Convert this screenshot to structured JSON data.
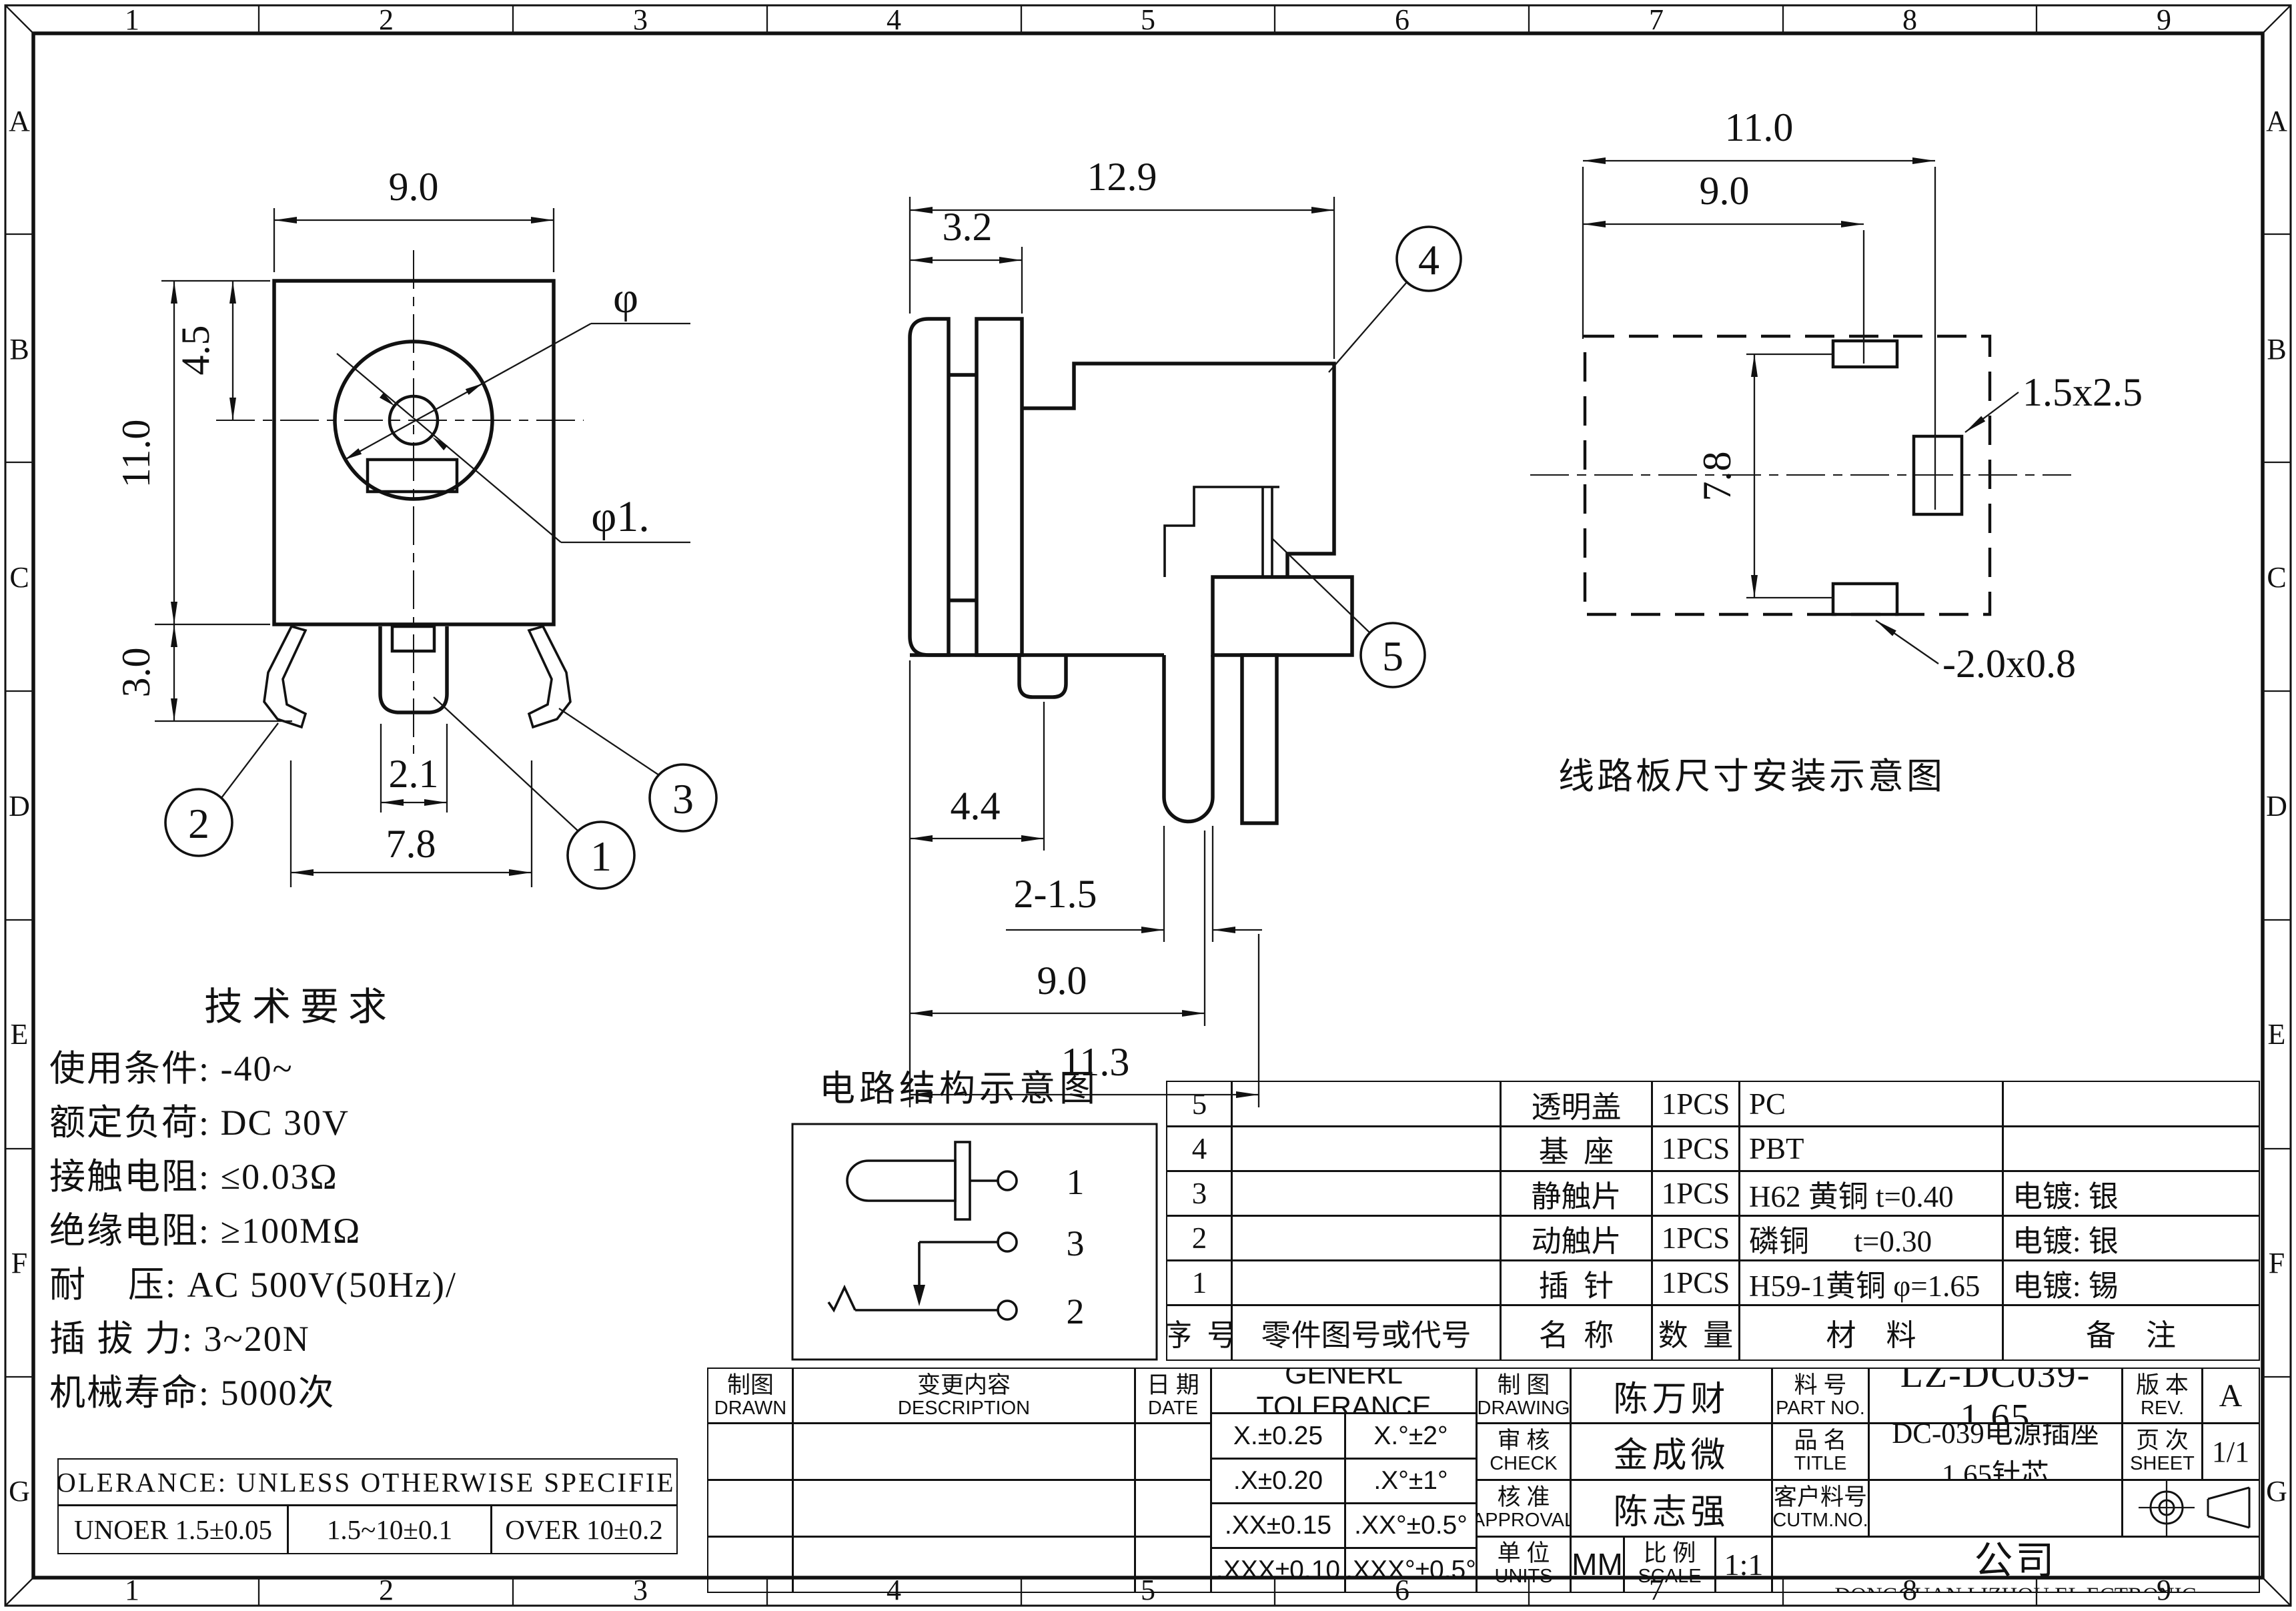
{
  "border": {
    "cols": [
      "1",
      "2",
      "3",
      "4",
      "5",
      "6",
      "7",
      "8",
      "9"
    ],
    "rows": [
      "A",
      "B",
      "C",
      "D",
      "E",
      "F",
      "G"
    ]
  },
  "front": {
    "w": "9.0",
    "ctr": "4.5",
    "h": "11.0",
    "leg": "3.0",
    "pin": "2.1",
    "span": "7.8",
    "dia": "φ",
    "dia1": "φ1.",
    "b1": "1",
    "b2": "2",
    "b3": "3"
  },
  "side": {
    "w": "12.9",
    "flange": "3.2",
    "tab": "4.4",
    "pins": "2-1.5",
    "span": "9.0",
    "total": "11.3",
    "b4": "4",
    "b5": "5"
  },
  "pcb": {
    "w": "11.0",
    "inner": "9.0",
    "h": "7.8",
    "slot_right": "1.5x2.5",
    "slot_bottom": "-2.0x0.8",
    "caption": "线路板尺寸安装示意图"
  },
  "circuit": {
    "title": "电路结构示意图",
    "t1": "1",
    "t3": "3",
    "t2": "2"
  },
  "tech": {
    "title": "技术要求",
    "line1": "使用条件: -40~",
    "line2": "额定负荷: DC 30V",
    "line3": "接触电阻: ≤0.03Ω",
    "line4": "绝缘电阻: ≥100MΩ",
    "line5": "耐    压: AC 500V(50Hz)/",
    "line6": "插 拔 力: 3~20N",
    "line7": "机械寿命: 5000次"
  },
  "tol": {
    "title": "TOLERANCE: UNLESS OTHERWISE SPECIFIED",
    "c1": "UNOER 1.5±0.05",
    "c2": "1.5~10±0.1",
    "c3": "OVER 10±0.2"
  },
  "parts": {
    "h_no": "序  号",
    "h_code": "零件图号或代号",
    "h_name": "名  称",
    "h_qty": "数  量",
    "h_mat": "材    料",
    "h_note": "备    注",
    "rows": [
      {
        "no": "5",
        "code": "",
        "name": "透明盖",
        "qty": "1PCS",
        "mat": "PC",
        "note": ""
      },
      {
        "no": "4",
        "code": "",
        "name": "基  座",
        "qty": "1PCS",
        "mat": "PBT",
        "note": ""
      },
      {
        "no": "3",
        "code": "",
        "name": "静触片",
        "qty": "1PCS",
        "mat": "H62 黄铜 t=0.40",
        "note": "电镀: 银"
      },
      {
        "no": "2",
        "code": "",
        "name": "动触片",
        "qty": "1PCS",
        "mat": "磷铜      t=0.30",
        "note": "电镀: 银"
      },
      {
        "no": "1",
        "code": "",
        "name": "插  针",
        "qty": "1PCS",
        "mat": "H59-1黄铜 φ=1.65",
        "note": "电镀: 锡"
      }
    ]
  },
  "tb": {
    "drawn_cn": "制图",
    "drawn_en": "DRAWN",
    "desc_cn": "变更内容",
    "desc_en": "DESCRIPTION",
    "date_cn": "日 期",
    "date_en": "DATE",
    "tol_header": "GENERL TOLERANCE",
    "t11": "X.±0.25",
    "t12": "X.°±2°",
    "t21": ".X±0.20",
    "t22": ".X°±1°",
    "t31": ".XX±0.15",
    "t32": ".XX°±0.5°",
    "t41": ".XXX±0.10",
    "t42": ".XXX°±0.5°",
    "drawing_cn": "制 图",
    "drawing_en": "DRAWING",
    "drawing_name": "陈万财",
    "check_cn": "审 核",
    "check_en": "CHECK",
    "check_name": "金成微",
    "approval_cn": "核 准",
    "approval_en": "APPROVAL",
    "approval_name": "陈志强",
    "units_cn": "单 位",
    "units_en": "UNITS",
    "units_val": "MM",
    "scale_cn": "比 例",
    "scale_en": "SCALE",
    "scale_val": "1:1",
    "part_cn": "料 号",
    "part_en": "PART NO.",
    "part_val": "LZ-DC039-1.65",
    "rev_cn": "版 本",
    "rev_en": "REV.",
    "rev_val": "A",
    "title_cn": "品 名",
    "title_en": "TITLE",
    "title_val": "DC-039电源插座1.65针芯",
    "sheet_cn": "页 次",
    "sheet_en": "SHEET",
    "sheet_val": "1/1",
    "cust_cn": "客户料号",
    "cust_en": "CUTM.NO.",
    "company_cn": "东莞市利洲电子科技有限公司",
    "company_en": "DONGGUAN LIZHOU EL ECTRONIC TECHNOLOGY CO.,LID"
  }
}
